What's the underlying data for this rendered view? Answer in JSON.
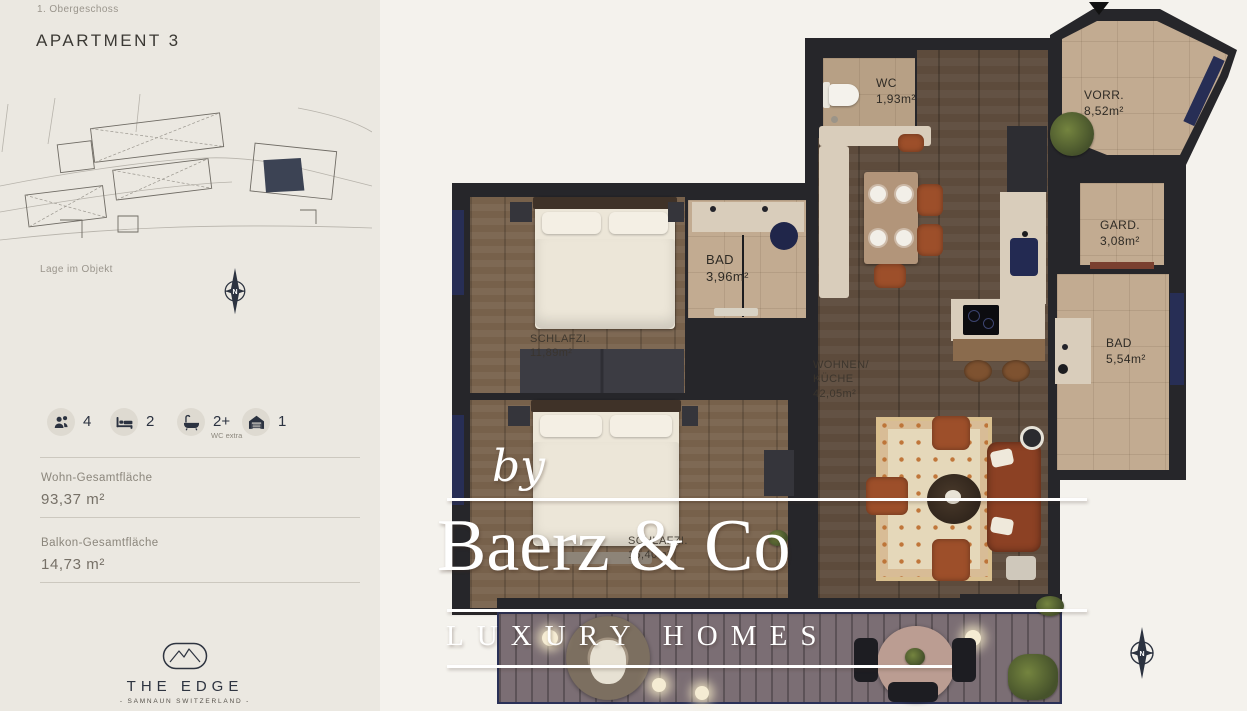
{
  "sidebar": {
    "floor_label": "1. Obergeschoss",
    "title": "APARTMENT 3",
    "siteplan_caption": "Lage im Objekt",
    "stats": {
      "occupants": {
        "value": "4"
      },
      "bedrooms": {
        "value": "2"
      },
      "baths": {
        "value": "2+",
        "note": "WC extra"
      },
      "garage": {
        "value": "1"
      }
    },
    "areas": {
      "living": {
        "label": "Wohn-Gesamtfläche",
        "value": "93,37 m²"
      },
      "balcony": {
        "label": "Balkon-Gesamtfläche",
        "value": "14,73 m²"
      }
    },
    "brand": {
      "name": "THE EDGE",
      "subtitle": "- SAMNAUN SWITZERLAND -"
    }
  },
  "floorplan": {
    "compass_label": "N",
    "rooms": {
      "wc": {
        "name": "WC",
        "area": "1,93m²"
      },
      "vorraum": {
        "name": "VORR.",
        "area": "8,52m²"
      },
      "garderobe": {
        "name": "GARD.",
        "area": "3,08m²"
      },
      "bad_klein": {
        "name": "BAD",
        "area": "3,96m²"
      },
      "bad_gross": {
        "name": "BAD",
        "area": "5,54m²"
      },
      "schlafzimmer_1": {
        "name": "SCHLAFZI.",
        "area": "11,89m²"
      },
      "schlafzimmer_2": {
        "name": "SCHLAFZI.",
        "area": "16,40m²"
      },
      "wohnen_kueche": {
        "name": "WOHNEN/\nKÜCHE",
        "area": "42,05m²"
      }
    }
  },
  "watermark": {
    "prefix": "by",
    "name": "Baerz & Co",
    "tagline": "LUXURY HOMES"
  },
  "colors": {
    "accent_navy": "#2b3240",
    "wall": "#26262a",
    "tile": "#c2ab91",
    "wood": "#6a5542",
    "rust": "#9d4f2a",
    "cream_bg": "#ebe8e1"
  }
}
